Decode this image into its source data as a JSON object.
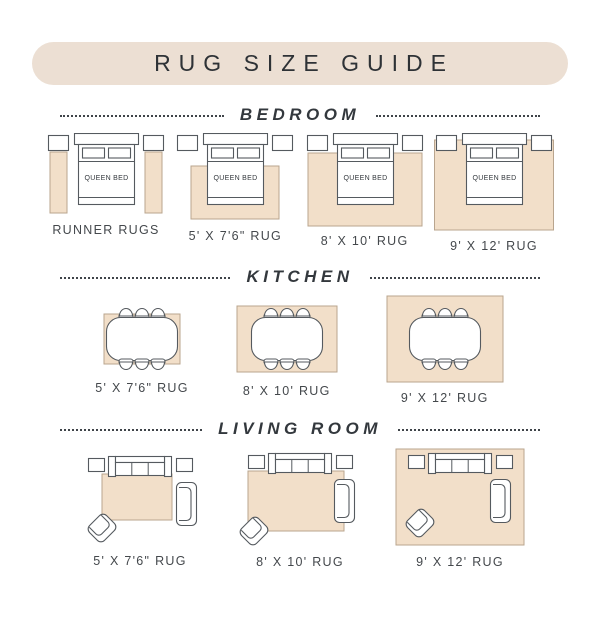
{
  "banner": {
    "title": "RUG SIZE GUIDE"
  },
  "bed_label": "QUEEN BED",
  "sections": [
    {
      "heading": "BEDROOM",
      "items": [
        {
          "label": "RUNNER RUGS",
          "icon": "queen-bed-with-runner-rugs"
        },
        {
          "label": "5' X 7'6\" RUG",
          "icon": "queen-bed-on-5x76-rug"
        },
        {
          "label": "8' X 10' RUG",
          "icon": "queen-bed-on-8x10-rug"
        },
        {
          "label": "9' X 12' RUG",
          "icon": "queen-bed-on-9x12-rug"
        }
      ]
    },
    {
      "heading": "KITCHEN",
      "items": [
        {
          "label": "5' X 7'6\" RUG",
          "icon": "dining-table-on-5x76-rug"
        },
        {
          "label": "8' X 10' RUG",
          "icon": "dining-table-on-8x10-rug"
        },
        {
          "label": "9' X 12' RUG",
          "icon": "dining-table-on-9x12-rug"
        }
      ]
    },
    {
      "heading": "LIVING ROOM",
      "items": [
        {
          "label": "5' X 7'6\" RUG",
          "icon": "sofa-set-on-5x76-rug"
        },
        {
          "label": "8' X 10' RUG",
          "icon": "sofa-set-on-8x10-rug"
        },
        {
          "label": "9' X 12' RUG",
          "icon": "sofa-set-on-9x12-rug"
        }
      ]
    }
  ],
  "colors": {
    "banner_bg": "#ECDFD3",
    "rug_fill": "#F2DFC9",
    "rug_border": "#B9A58E",
    "furniture_outline": "#555A5F",
    "heading_text": "#33383D",
    "label_text": "#44484C"
  }
}
